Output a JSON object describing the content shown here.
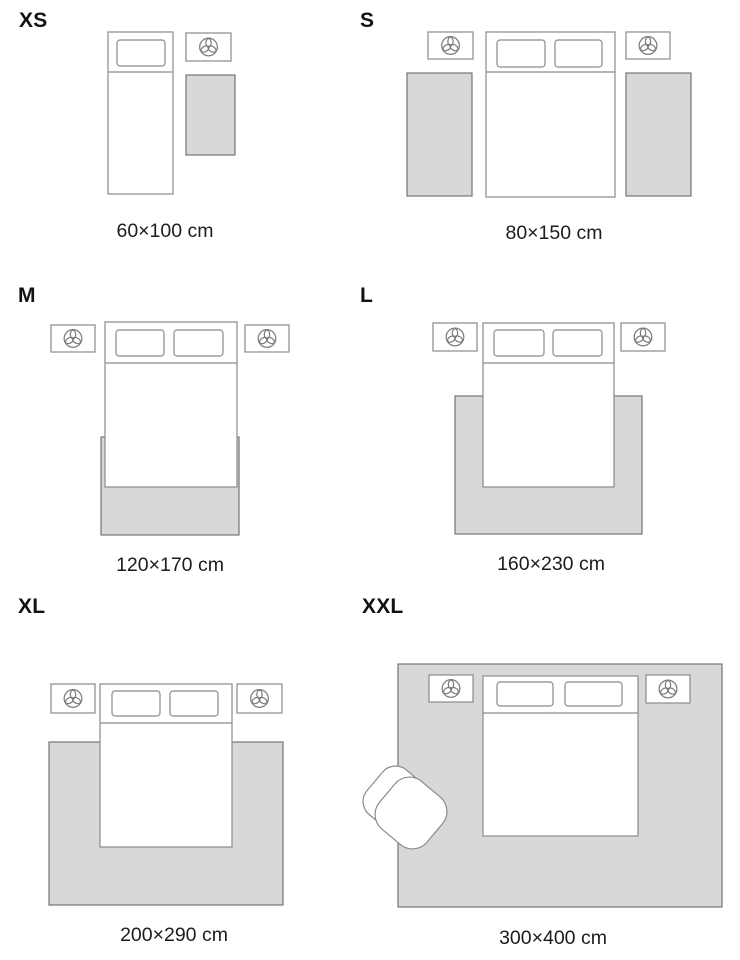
{
  "title": "Rug size guide",
  "colors": {
    "background": "#ffffff",
    "furniture_outline": "#8a8a8a",
    "rug_fill": "#d8d8d8",
    "rug_outline": "#747474",
    "text": "#1c1c1c"
  },
  "icons": {
    "nightstand_decor": "trefoil-flower-icon"
  },
  "panels": [
    {
      "letter": "XS",
      "size": "60×100 cm",
      "scene": "single bed with small rug beside it"
    },
    {
      "letter": "S",
      "size": "80×150 cm",
      "scene": "double bed with a runner rug on each side"
    },
    {
      "letter": "M",
      "size": "120×170 cm",
      "scene": "double bed with rug under foot of bed"
    },
    {
      "letter": "L",
      "size": "160×230 cm",
      "scene": "double bed with rug extending past both sides"
    },
    {
      "letter": "XL",
      "size": "200×290 cm",
      "scene": "double bed with large rug under two-thirds of bed"
    },
    {
      "letter": "XXL",
      "size": "300×400 cm",
      "scene": "room-size rug under bed, nightstands and armchair"
    }
  ]
}
